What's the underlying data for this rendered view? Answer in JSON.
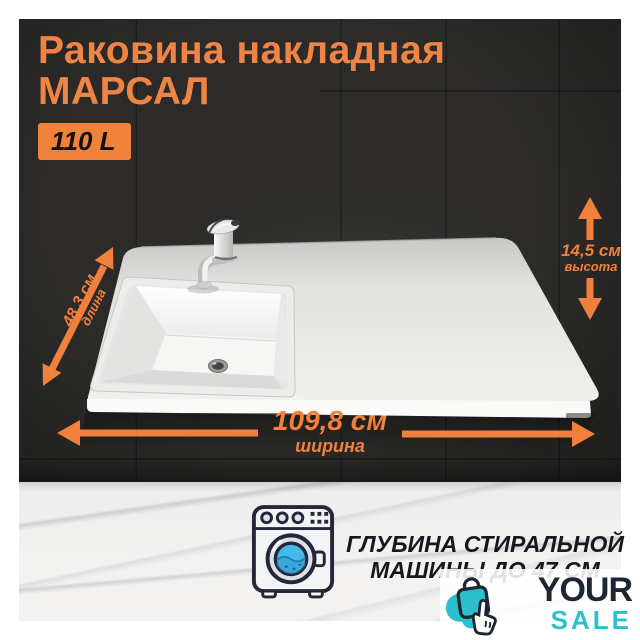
{
  "product": {
    "title_line1": "Раковина накладная",
    "title_line2": "МАРСАЛ",
    "volume_badge": "110 L"
  },
  "dimensions": {
    "length": {
      "value": "48,3 см",
      "label": "длина"
    },
    "width": {
      "value": "109,8 см",
      "label": "ширина"
    },
    "height": {
      "value": "14,5 см",
      "label": "высота"
    }
  },
  "caption": {
    "line1": "ГЛУБИНА СТИРАЛЬНОЙ",
    "line2": "МАШИНЫ ДО 47 СМ"
  },
  "brand": {
    "name_top": "YOUR",
    "name_bottom": "SALE"
  },
  "icons": {
    "washing_machine": "washing-machine-icon",
    "brand": "shopping-bag-click-icon"
  },
  "colors": {
    "accent_orange": "#F0803C",
    "wall_dark": "#2C2B29",
    "brand_teal": "#2CC0CE",
    "brand_navy": "#1D2733",
    "caption_text": "#17171D",
    "sink_white": "#EFEFEE"
  }
}
